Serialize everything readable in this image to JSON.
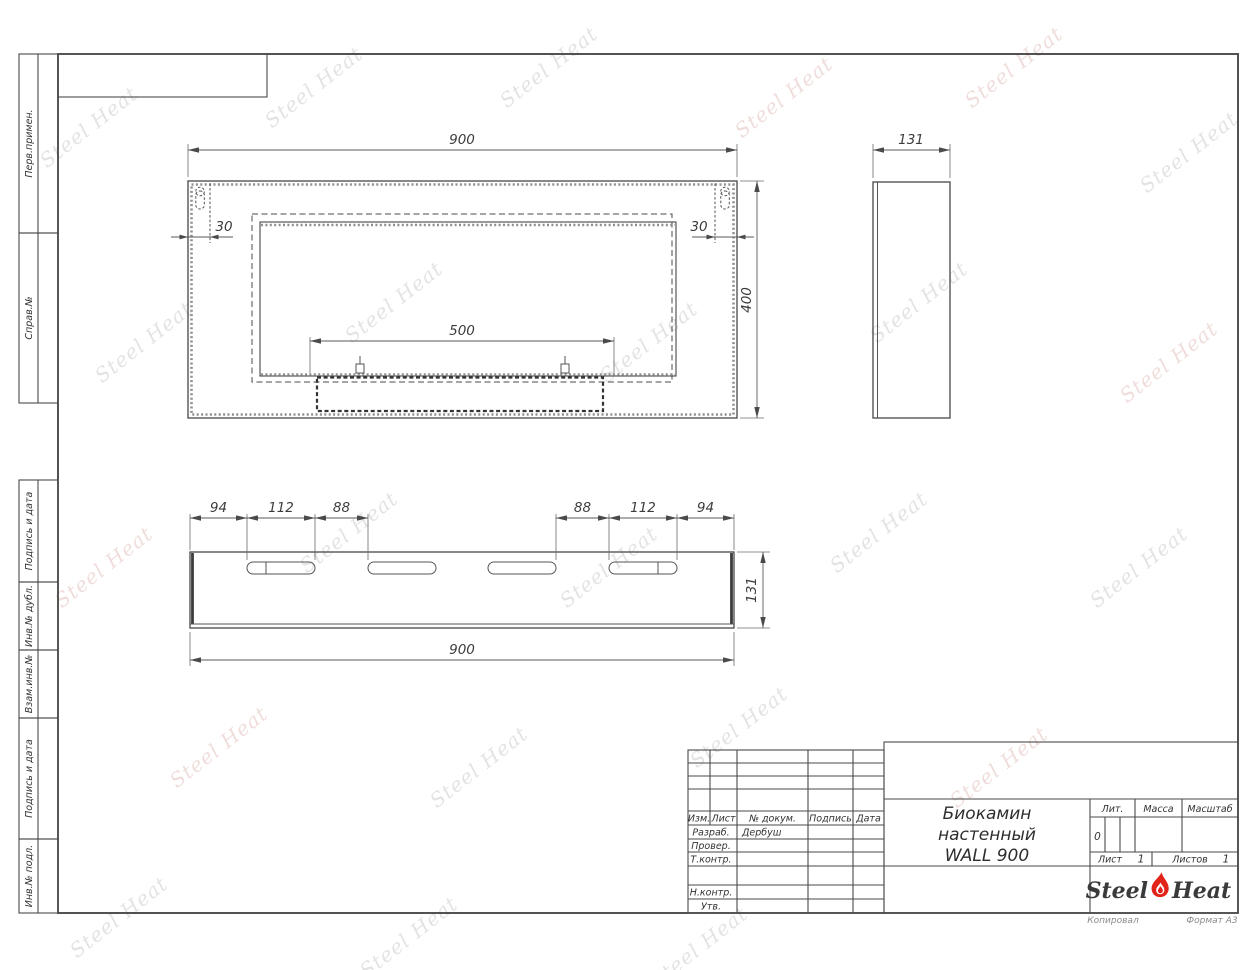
{
  "sheet": {
    "copied_label": "Копировал",
    "format_label": "Формат А3"
  },
  "margin_labels": {
    "perv": "Перв.примен.",
    "sprav": "Справ.№",
    "podpis1": "Подпись и дата",
    "inv_dubl": "Инв.№ дубл.",
    "vzam": "Взам.инв.№",
    "podpis2": "Подпись и дата",
    "inv_podl": "Инв.№ подл."
  },
  "dims": {
    "front_width": "900",
    "front_height": "400",
    "front_offset_left": "30",
    "front_offset_right": "30",
    "burner_width": "500",
    "side_width": "131",
    "bottom_width": "900",
    "bottom_height": "131",
    "slot_left_edge": "94",
    "slot_left_width": "112",
    "slot_left_gap": "88",
    "slot_right_gap": "88",
    "slot_right_width": "112",
    "slot_right_edge": "94"
  },
  "title_block": {
    "col_izm": "Изм.",
    "col_list": "Лист",
    "col_doc": "№ докум.",
    "col_sign": "Подпись",
    "col_date": "Дата",
    "razrab_label": "Разраб.",
    "razrab_value": "Дербуш",
    "prover_label": "Провер.",
    "tkontr_label": "Т.контр.",
    "nkontr_label": "Н.контр.",
    "utv_label": "Утв.",
    "title_line1": "Биокамин",
    "title_line2": "настенный",
    "title_line3": "WALL 900",
    "lit_label": "Лит.",
    "lit_value": "0",
    "mass_label": "Масса",
    "scale_label": "Масштаб",
    "sheet_label": "Лист",
    "sheet_value": "1",
    "sheets_label": "Листов",
    "sheets_value": "1"
  },
  "brand": {
    "steel": "Steel",
    "heat": "Heat",
    "watermark": "Steel Heat"
  }
}
